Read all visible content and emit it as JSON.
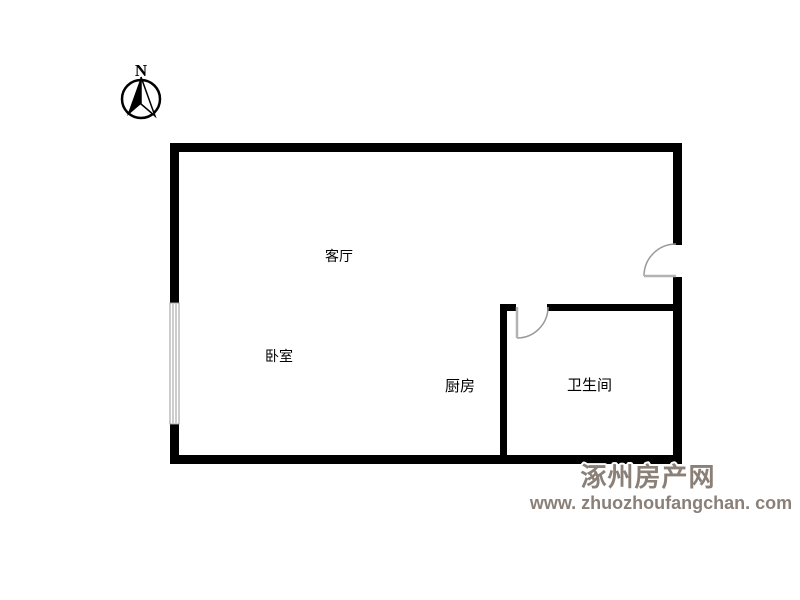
{
  "title": "floor-plan",
  "compass": {
    "label": "N"
  },
  "rooms": [
    {
      "id": "living-room",
      "label": "客厅"
    },
    {
      "id": "bedroom",
      "label": "卧室"
    },
    {
      "id": "kitchen",
      "label": "厨房"
    },
    {
      "id": "bathroom",
      "label": "卫生间"
    }
  ],
  "watermark": {
    "site_name": "涿州房产网",
    "site_url": "www. zhuozhoufangchan. com"
  },
  "colors": {
    "background": "#ffffff",
    "wall": "#000000",
    "door_arc": "#999999",
    "door_leaf": "#b3b3b3",
    "window_frame": "#999999",
    "label_text": "#000000",
    "watermark": "#8a8078"
  }
}
